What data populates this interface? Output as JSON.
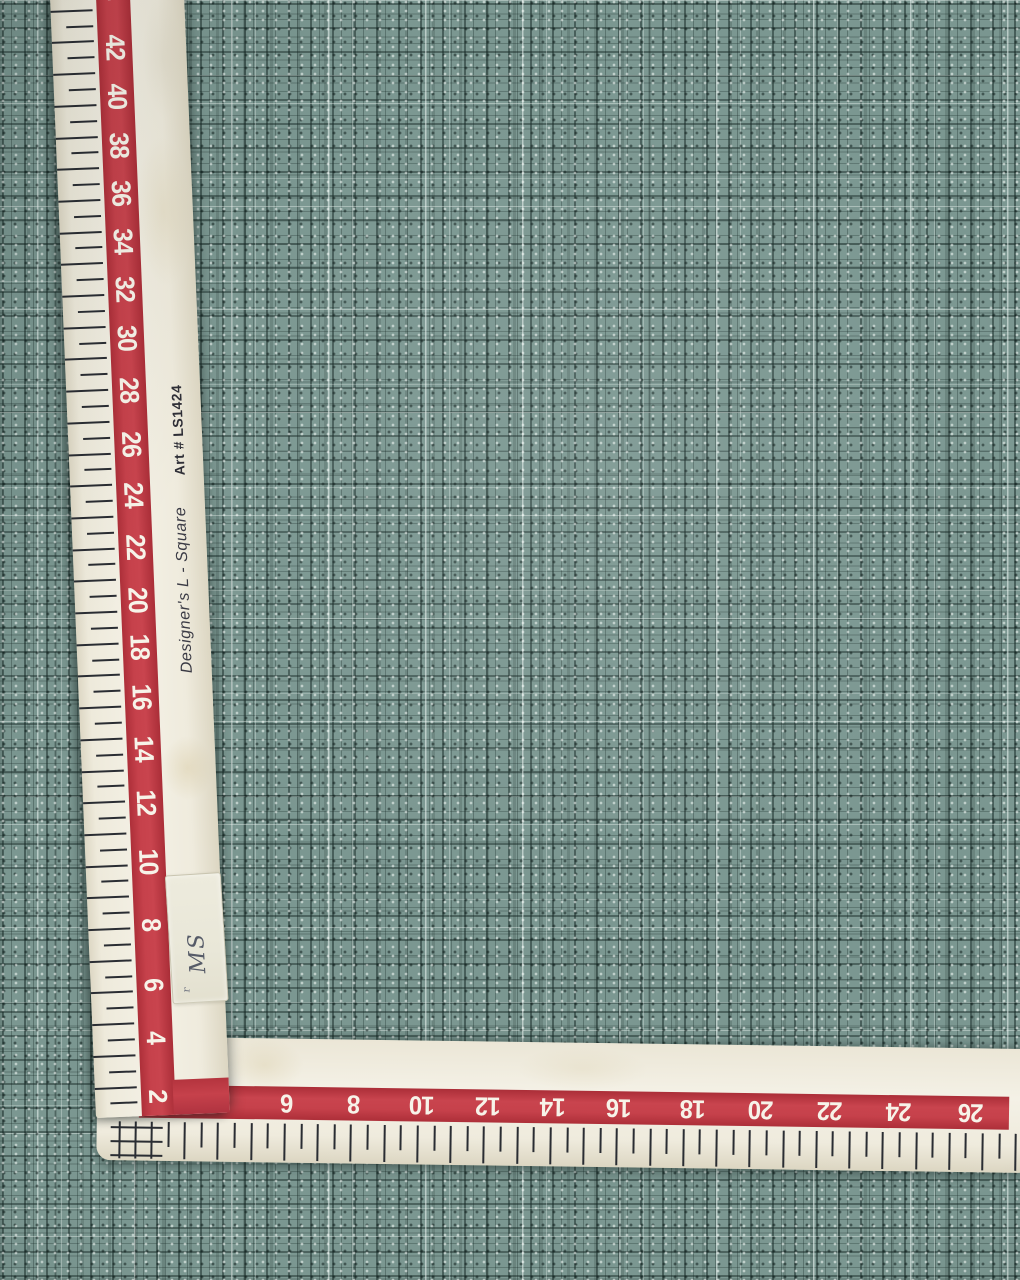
{
  "ruler": {
    "brand": "Designer's  L - Square",
    "art_number": "Art # LS1424",
    "vertical_scale_labels": [
      "44",
      "42",
      "40",
      "38",
      "36",
      "34",
      "32",
      "30",
      "28",
      "26",
      "24",
      "22",
      "20",
      "18",
      "16",
      "14",
      "12",
      "10",
      "8",
      "6",
      "4"
    ],
    "corner_label": "2",
    "horizontal_scale_labels": [
      "4",
      "6",
      "8",
      "10",
      "12",
      "14",
      "16",
      "18",
      "20",
      "22",
      "24",
      "26"
    ],
    "sticker_text": "MS",
    "colors": {
      "stripe_red": "#c13a43",
      "ruler_cream": "#f2efe4",
      "tick_black": "#2a2d33",
      "number_text": "#f7f3e9"
    }
  },
  "fabric": {
    "base_color": "#7b9791",
    "dark_thread_color": "#1d322e",
    "light_thread_color": "#e9f2ee"
  }
}
